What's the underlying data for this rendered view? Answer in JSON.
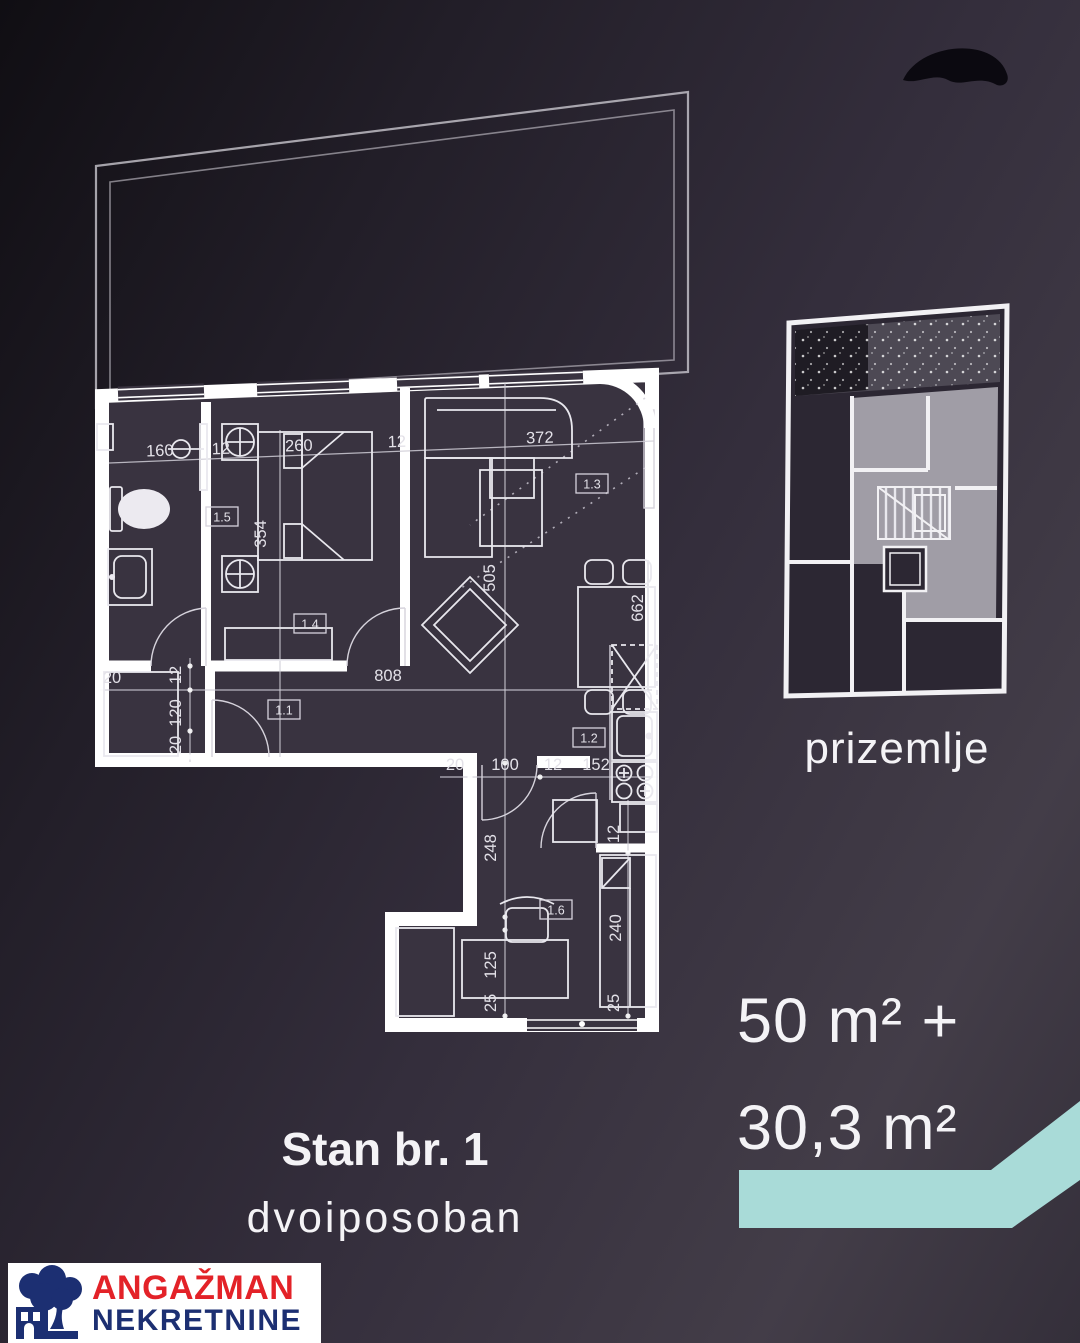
{
  "poster": {
    "floor_label": "prizemlje",
    "area_line1": "50 m² +",
    "area_line2": "30,3 m²",
    "unit_title": "Stan br. 1",
    "unit_subtitle": "dvoiposoban"
  },
  "logo": {
    "line1": "ANGAŽMAN",
    "line2": "NEKRETNINE"
  },
  "colors": {
    "accent": "#a9dbd8",
    "wall": "#ffffff",
    "plan-fill": "#393340",
    "dim": "#e3e1e8",
    "text": "#f4f3f6",
    "logo-red": "#e32228",
    "logo-navy": "#1c2f72",
    "mini-gray": "#a09da6"
  },
  "icons": [
    "bird-silhouette",
    "tree-house-logo"
  ],
  "floorplan": {
    "dimensions": [
      {
        "t": "160",
        "x": 160,
        "y": 456,
        "r": -2
      },
      {
        "t": "12",
        "x": 221,
        "y": 454,
        "r": -2
      },
      {
        "t": "260",
        "x": 299,
        "y": 451,
        "r": -2
      },
      {
        "t": "12",
        "x": 397,
        "y": 447,
        "r": -2
      },
      {
        "t": "372",
        "x": 540,
        "y": 443,
        "r": -2
      },
      {
        "t": "354",
        "x": 266,
        "y": 534,
        "r": -90
      },
      {
        "t": "505",
        "x": 495,
        "y": 578,
        "r": -90
      },
      {
        "t": "662",
        "x": 643,
        "y": 608,
        "r": -90
      },
      {
        "t": "808",
        "x": 388,
        "y": 681,
        "r": 0
      },
      {
        "t": "20",
        "x": 112,
        "y": 683,
        "r": 0
      },
      {
        "t": "12",
        "x": 181,
        "y": 675,
        "r": -90
      },
      {
        "t": "120",
        "x": 181,
        "y": 713,
        "r": -90
      },
      {
        "t": "20",
        "x": 181,
        "y": 745,
        "r": -90
      },
      {
        "t": "20",
        "x": 455,
        "y": 770,
        "r": 0
      },
      {
        "t": "100",
        "x": 505,
        "y": 770,
        "r": 0
      },
      {
        "t": "12",
        "x": 553,
        "y": 770,
        "r": 0
      },
      {
        "t": "152",
        "x": 596,
        "y": 770,
        "r": 0
      },
      {
        "t": "248",
        "x": 496,
        "y": 848,
        "r": -90
      },
      {
        "t": "12",
        "x": 619,
        "y": 834,
        "r": -90
      },
      {
        "t": "240",
        "x": 621,
        "y": 928,
        "r": -90
      },
      {
        "t": "125",
        "x": 496,
        "y": 965,
        "r": -90
      },
      {
        "t": "25",
        "x": 496,
        "y": 1003,
        "r": -90
      },
      {
        "t": "25",
        "x": 619,
        "y": 1003,
        "r": -90
      }
    ],
    "room_markers": [
      {
        "t": "1.1",
        "x": 284,
        "y": 710
      },
      {
        "t": "1.2",
        "x": 589,
        "y": 738
      },
      {
        "t": "1.3",
        "x": 592,
        "y": 484
      },
      {
        "t": "1.4",
        "x": 310,
        "y": 624
      },
      {
        "t": "1.5",
        "x": 222,
        "y": 517
      },
      {
        "t": "1.6",
        "x": 556,
        "y": 910
      }
    ]
  }
}
